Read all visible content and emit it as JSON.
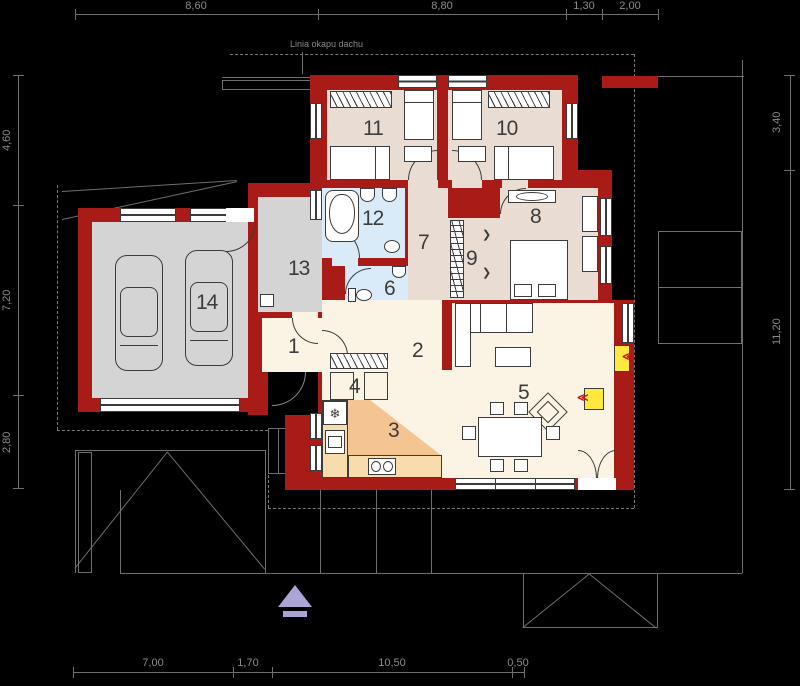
{
  "annotations": {
    "eave_label": "Linia okapu dachu"
  },
  "dimensions": {
    "top": [
      "8,60",
      "8,80",
      "1,30",
      "2,00"
    ],
    "left": [
      "4,60",
      "7,20",
      "2,80"
    ],
    "right": [
      "3,40",
      "11,20"
    ],
    "bottom": [
      "7,00",
      "1,70",
      "10,50",
      "0,50"
    ]
  },
  "rooms": {
    "r1": "1",
    "r2": "2",
    "r3": "3",
    "r4": "4",
    "r5": "5",
    "r6": "6",
    "r7": "7",
    "r8": "8",
    "r9": "9",
    "r10": "10",
    "r11": "11",
    "r12": "12",
    "r13": "13",
    "r14": "14"
  },
  "colors": {
    "wall": "#a81b17",
    "bedroom_floor": "#e9ddd3",
    "cream_floor": "#fbf3e3",
    "bath_floor": "#d9ebf8",
    "garage_floor": "#d4d4d4",
    "kitchen_floor": "#f5c493",
    "counter": "#f9dcae",
    "fireplace_yellow": "#ffe93e",
    "accent_red": "#cc1414",
    "north_arrow": "#aba4d6",
    "site_line": "#6e6e6e",
    "furniture_line": "#3c3c3c"
  },
  "symbols": {
    "fridge_icon": "❄",
    "sink_bowls": "2",
    "wardrobe_chevron": "≪"
  }
}
